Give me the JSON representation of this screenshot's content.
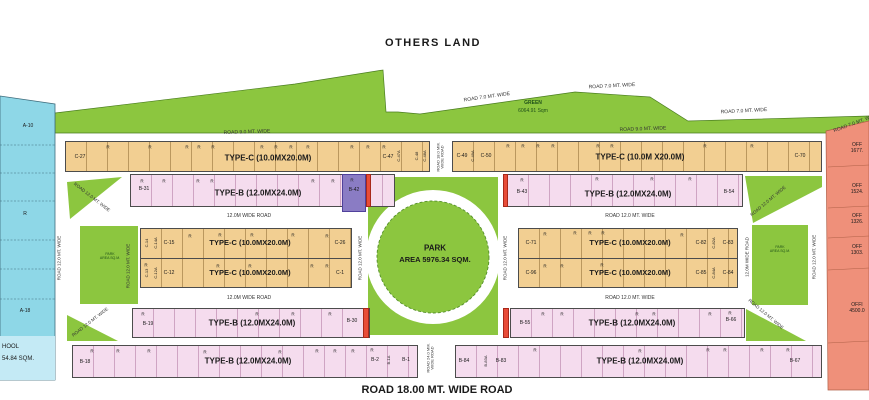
{
  "others_land": "OTHERS LAND",
  "bottom_road": "ROAD 18.00 MT. WIDE ROAD",
  "r": "R",
  "park": {
    "l1": "PARK",
    "l2": "AREA 5976.34 SQM."
  },
  "green_area": {
    "l1": "GREEN",
    "l2": "6064.91 Sqm"
  },
  "mini_park": {
    "l1": "PARK",
    "l2": "AREA SQ.M."
  },
  "school": {
    "l1": "HOOL",
    "l2": "54.84 SQM."
  },
  "types": {
    "c": "TYPE-C (10.0MX20.0M)",
    "c_sp": "TYPE-C (10.0M X20.0M)",
    "b": "TYPE-B (12.0MX24.0M)"
  },
  "roads": {
    "w7": "ROAD 7.0 MT. WIDE",
    "w9": "ROAD 9.0 MT. WIDE",
    "w12": "ROAD 12.0 MT. WIDE",
    "w12m": "12.0M WIDE ROAD",
    "v18a": "ROAD 18.0 MM.",
    "v18b": "WIDE ROAD",
    "v24a": "ROAD 24.0 MM.",
    "v24b": "WIDE ROAD"
  },
  "p": {
    "a10": "A-10",
    "a18": "A-18",
    "c27": "C-27",
    "c47": "C-47",
    "c47a": "C-47A",
    "c48": "C-48",
    "c48a": "C-48A",
    "c49": "C-49",
    "c49a": "C-49A",
    "c50": "C-50",
    "c70": "C-70",
    "b31": "B-31",
    "b42": "B-42",
    "b43": "B-43",
    "b54": "B-54",
    "c14": "C-14",
    "c14a": "C-14A",
    "c15": "C-15",
    "c26": "C-26",
    "c13": "C-13",
    "c12a": "C-12A",
    "c12": "C-12",
    "c1": "C-1",
    "c71": "C-71",
    "c82": "C-82",
    "c82a": "C-82A",
    "c83": "C-83",
    "c96": "C-96",
    "c85": "C-85",
    "c84a": "C-84A",
    "c84": "C-84",
    "b19": "B-19",
    "b30": "B-30",
    "b18": "B-18",
    "b2": "B-2",
    "b1a": "B-1A",
    "b1": "B-1",
    "b55": "B-55",
    "b66": "B-66",
    "b84": "B-84",
    "b83a": "B-83A",
    "b83": "B-83",
    "b67": "B-67"
  },
  "offices": [
    {
      "l1": "OFF",
      "l2": "1677."
    },
    {
      "l1": "OFF",
      "l2": "1524."
    },
    {
      "l1": "OFF",
      "l2": "1326."
    },
    {
      "l1": "OFF",
      "l2": "1303."
    },
    {
      "l1": "OFFI",
      "l2": "4500.0"
    }
  ],
  "colors": {
    "green": "#8CC63F",
    "plot_blue": "#8ED7E7",
    "school_blue": "#C4EAF5",
    "plot_orange": "#F2CF92",
    "plot_pink": "#F5DCEE",
    "plot_purple": "#8A7CC4",
    "office_salmon": "#EF907A",
    "marker_red": "#E84C38"
  },
  "r_marks": [
    [
      108,
      147
    ],
    [
      150,
      147
    ],
    [
      187,
      147
    ],
    [
      199,
      147
    ],
    [
      213,
      147
    ],
    [
      262,
      147
    ],
    [
      276,
      147
    ],
    [
      291,
      147
    ],
    [
      308,
      147
    ],
    [
      352,
      147
    ],
    [
      368,
      147
    ],
    [
      384,
      147
    ],
    [
      142,
      181
    ],
    [
      164,
      181
    ],
    [
      198,
      181
    ],
    [
      212,
      181
    ],
    [
      313,
      181
    ],
    [
      333,
      181
    ],
    [
      352,
      180
    ],
    [
      508,
      146
    ],
    [
      523,
      146
    ],
    [
      538,
      146
    ],
    [
      553,
      146
    ],
    [
      598,
      146
    ],
    [
      612,
      146
    ],
    [
      705,
      146
    ],
    [
      752,
      146
    ],
    [
      522,
      180
    ],
    [
      597,
      179
    ],
    [
      652,
      179
    ],
    [
      690,
      179
    ],
    [
      190,
      236
    ],
    [
      220,
      235
    ],
    [
      252,
      235
    ],
    [
      293,
      235
    ],
    [
      327,
      236
    ],
    [
      146,
      265
    ],
    [
      218,
      266
    ],
    [
      250,
      266
    ],
    [
      312,
      266
    ],
    [
      327,
      266
    ],
    [
      545,
      234
    ],
    [
      575,
      233
    ],
    [
      590,
      233
    ],
    [
      603,
      233
    ],
    [
      682,
      235
    ],
    [
      545,
      266
    ],
    [
      562,
      266
    ],
    [
      602,
      265
    ],
    [
      143,
      314
    ],
    [
      257,
      314
    ],
    [
      293,
      314
    ],
    [
      330,
      314
    ],
    [
      92,
      351
    ],
    [
      118,
      351
    ],
    [
      149,
      351
    ],
    [
      205,
      352
    ],
    [
      280,
      352
    ],
    [
      317,
      351
    ],
    [
      335,
      351
    ],
    [
      353,
      351
    ],
    [
      372,
      350
    ],
    [
      543,
      314
    ],
    [
      562,
      314
    ],
    [
      637,
      314
    ],
    [
      654,
      314
    ],
    [
      710,
      314
    ],
    [
      730,
      313
    ],
    [
      535,
      350
    ],
    [
      640,
      351
    ],
    [
      708,
      350
    ],
    [
      725,
      350
    ],
    [
      762,
      350
    ],
    [
      788,
      350
    ]
  ]
}
